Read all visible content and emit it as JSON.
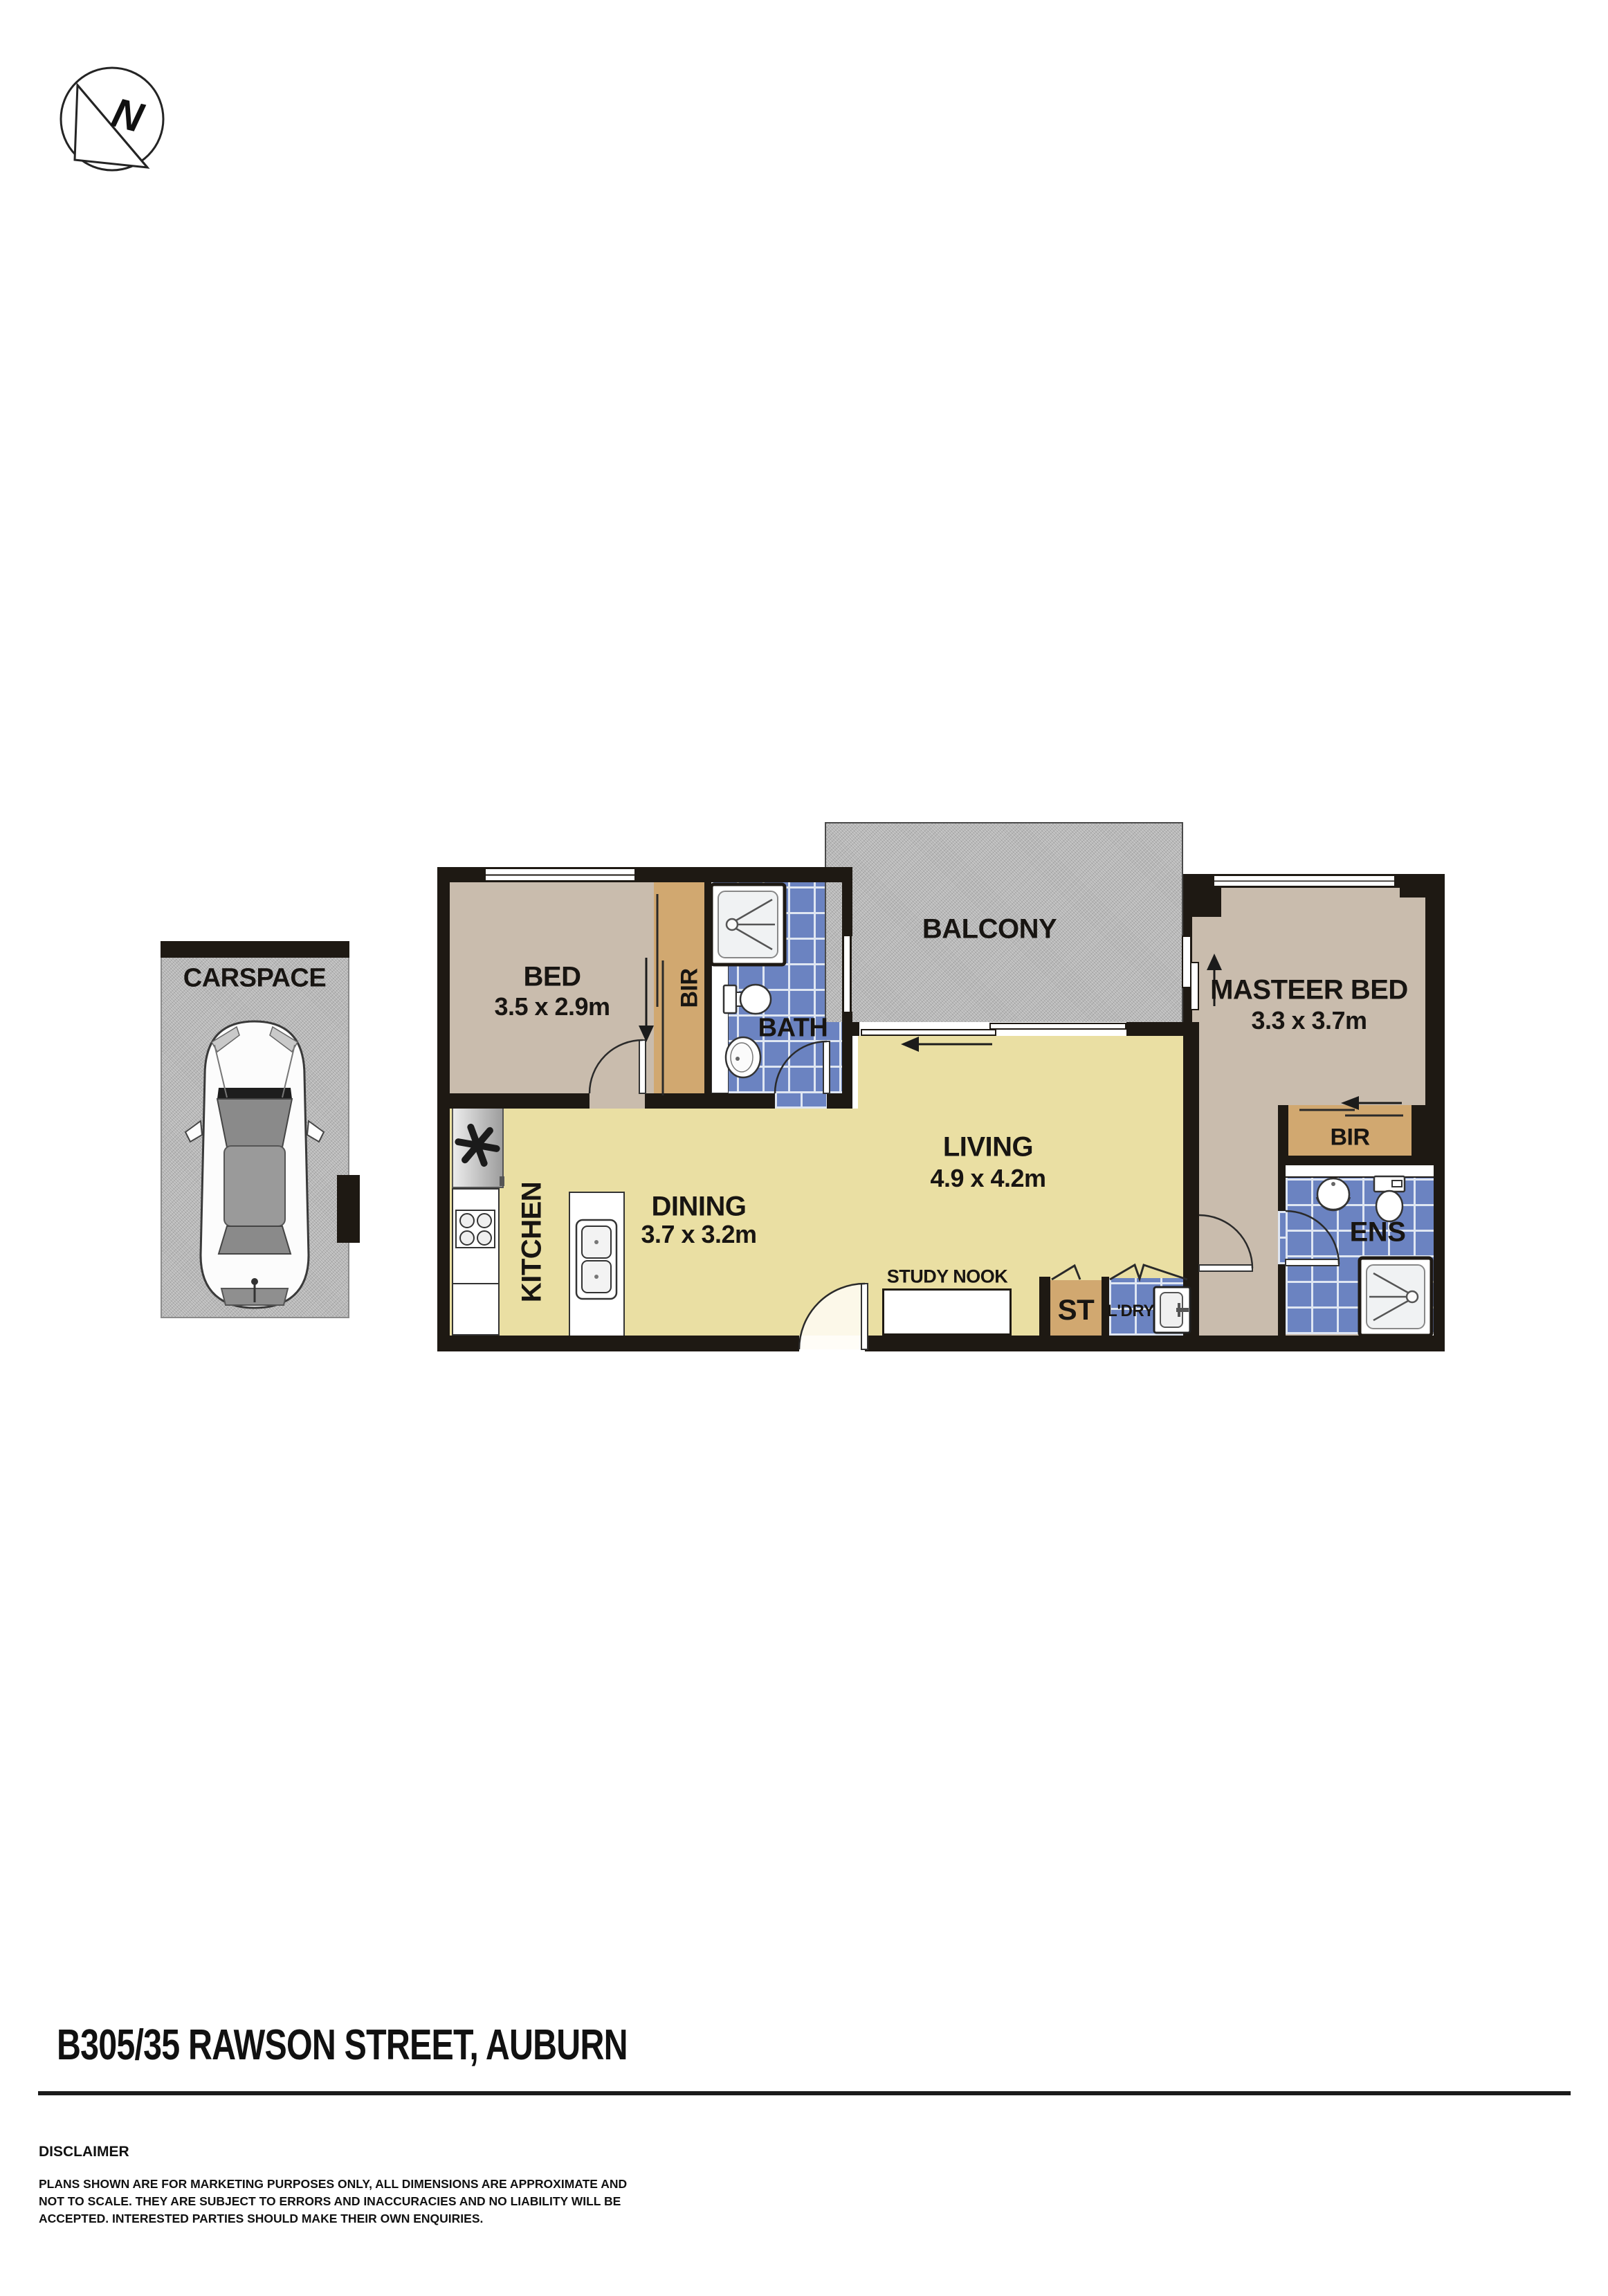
{
  "compass": {
    "letter": "N"
  },
  "carspace": {
    "label": "CARSPACE"
  },
  "rooms": {
    "bed": {
      "name": "BED",
      "dims": "3.5 x 2.9m"
    },
    "bir_bed": {
      "name": "BIR"
    },
    "bath": {
      "name": "BATH"
    },
    "balcony": {
      "name": "BALCONY"
    },
    "master": {
      "name": "MASTEER BED",
      "dims": "3.3 x 3.7m"
    },
    "bir_master": {
      "name": "BIR"
    },
    "ens": {
      "name": "ENS"
    },
    "living": {
      "name": "LIVING",
      "dims": "4.9 x 4.2m"
    },
    "dining": {
      "name": "DINING",
      "dims": "3.7 x 3.2m"
    },
    "kitchen": {
      "name": "KITCHEN"
    },
    "study_nook": {
      "name": "STUDY NOOK"
    },
    "storage": {
      "name": "ST"
    },
    "laundry": {
      "name": "L'DRY"
    }
  },
  "footer": {
    "address": "B305/35 RAWSON STREET, AUBURN",
    "disclaimer_heading": "DISCLAIMER",
    "disclaimer_lines": [
      "PLANS SHOWN ARE FOR MARKETING PURPOSES ONLY, ALL DIMENSIONS ARE APPROXIMATE AND",
      "NOT TO SCALE. THEY ARE SUBJECT TO ERRORS AND INACCURACIES AND NO LIABILITY WILL BE",
      "ACCEPTED. INTERESTED PARTIES SHOULD MAKE THEIR OWN ENQUIRIES."
    ]
  },
  "colors": {
    "wall": "#1e1913",
    "bedroom_fill": "#c9bcad",
    "wardrobe_fill": "#d1a870",
    "living_fill": "#eadfa3",
    "wet_area_tile": "#6b83c1",
    "outdoor_concrete": "#b7b7b7"
  },
  "icons": [
    "north-compass-icon",
    "car-icon",
    "fridge-icon",
    "stove-icon",
    "kitchen-sink-icon",
    "shower-icon",
    "toilet-icon",
    "basin-icon",
    "washing-machine-icon",
    "door-swing-icon",
    "sliding-door-arrow-icon",
    "bifold-door-icon"
  ]
}
